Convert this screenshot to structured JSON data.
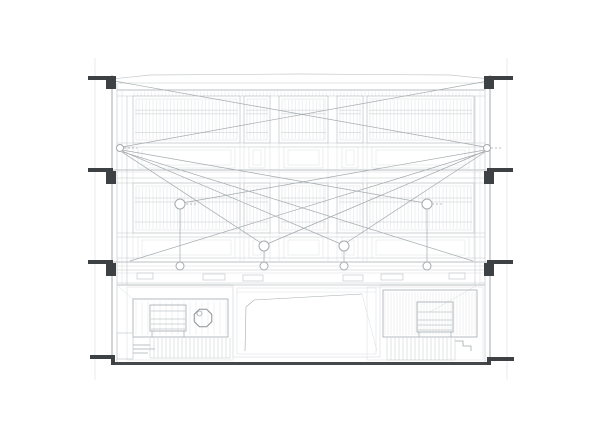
{
  "canvas": {
    "width": 600,
    "height": 423,
    "background": "#ffffff"
  },
  "colors": {
    "faint": "#dadde0",
    "light": "#c4c9cc",
    "mid": "#a4abaf",
    "dark": "#8b9296",
    "ink": "#3e4144",
    "ground": "#45484a",
    "white": "#ffffff"
  },
  "drawing": {
    "guides": {
      "xs": [
        95,
        507
      ],
      "y0": 58,
      "y1": 380
    },
    "roof_arc": [
      [
        112,
        79
      ],
      [
        150,
        75
      ],
      [
        300,
        74
      ],
      [
        450,
        75
      ],
      [
        490,
        79
      ]
    ],
    "slab_lines": {
      "light": [
        [
          118,
          83,
          484
        ],
        [
          117,
          96,
          485
        ],
        [
          117,
          143,
          485
        ],
        [
          117,
          147,
          485
        ],
        [
          117,
          178,
          485
        ],
        [
          117,
          183,
          485
        ],
        [
          117,
          233,
          485
        ],
        [
          117,
          237,
          485
        ],
        [
          117,
          258,
          485
        ],
        [
          117,
          270,
          485
        ],
        [
          117,
          283,
          485
        ]
      ],
      "mid": [
        [
          117,
          90,
          485
        ],
        [
          113,
          170,
          489
        ],
        [
          113,
          262,
          489
        ],
        [
          117,
          285,
          485
        ]
      ],
      "faint": [
        [
          117,
          172,
          485
        ],
        [
          117,
          266,
          485
        ],
        [
          117,
          273,
          485
        ]
      ]
    },
    "walls": {
      "left": [
        {
          "x": 112,
          "y0": 75,
          "y1": 365,
          "tone": "mid",
          "w": 1
        },
        {
          "x": 117,
          "y0": 83,
          "y1": 362,
          "tone": "light",
          "w": 0.7
        },
        {
          "x": 122,
          "y0": 90,
          "y1": 285,
          "tone": "faint",
          "w": 0.5
        },
        {
          "x": 127,
          "y0": 96,
          "y1": 285,
          "tone": "light",
          "w": 0.6
        }
      ],
      "right": [
        {
          "x": 490,
          "y0": 75,
          "y1": 365,
          "tone": "mid",
          "w": 1
        },
        {
          "x": 485,
          "y0": 83,
          "y1": 362,
          "tone": "light",
          "w": 0.7
        },
        {
          "x": 480,
          "y0": 90,
          "y1": 285,
          "tone": "faint",
          "w": 0.5
        },
        {
          "x": 475,
          "y0": 96,
          "y1": 285,
          "tone": "light",
          "w": 0.6
        }
      ]
    },
    "floors": [
      {
        "y0": 96,
        "y1": 143,
        "sp0": 147,
        "sp1": 168
      },
      {
        "y0": 183,
        "y1": 233,
        "sp0": 237,
        "sp1": 258
      }
    ],
    "modules": [
      [
        133,
        240
      ],
      [
        244,
        270
      ],
      [
        279,
        328
      ],
      [
        337,
        363
      ],
      [
        367,
        474
      ]
    ],
    "window_style": {
      "mullion_step": 3.5,
      "h_fracs": [
        0.3,
        0.38,
        0.78
      ]
    },
    "stub_mullions": {
      "x0": 134,
      "x1": 473,
      "step": 3.5,
      "y0": 91.5,
      "y1": 96
    },
    "markers": {
      "left": [
        {
          "bar": [
            88,
            76,
            25,
            4
          ],
          "sq": [
            106,
            76,
            10,
            13
          ]
        },
        {
          "bar": [
            88,
            168,
            25,
            4
          ],
          "sq": [
            106,
            171,
            10,
            13
          ]
        },
        {
          "bar": [
            88,
            260,
            25,
            4
          ],
          "sq": [
            106,
            263,
            10,
            13
          ]
        },
        {
          "bar": [
            90,
            355,
            24,
            4
          ]
        }
      ],
      "right": [
        {
          "bar": [
            487,
            76,
            26,
            4
          ],
          "sq": [
            484,
            76,
            10,
            13
          ]
        },
        {
          "bar": [
            487,
            168,
            26,
            4
          ],
          "sq": [
            484,
            171,
            10,
            13
          ]
        },
        {
          "bar": [
            487,
            260,
            26,
            4
          ],
          "sq": [
            484,
            263,
            10,
            13
          ]
        },
        {
          "bar": [
            489,
            357,
            25,
            4
          ]
        }
      ]
    },
    "vents": [
      [
        137,
        273,
        16,
        6
      ],
      [
        203,
        274,
        22,
        6
      ],
      [
        243,
        275,
        20,
        6
      ],
      [
        343,
        275,
        20,
        6
      ],
      [
        381,
        274,
        22,
        6
      ],
      [
        449,
        273,
        16,
        6
      ]
    ],
    "diagonals": [
      [
        114,
        81,
        485,
        147
      ],
      [
        488,
        81,
        122,
        147
      ],
      [
        122,
        150,
        425,
        203
      ],
      [
        485,
        150,
        182,
        203
      ],
      [
        122,
        151,
        341,
        244
      ],
      [
        485,
        151,
        267,
        244
      ],
      [
        122,
        152,
        261,
        243
      ],
      [
        485,
        152,
        346,
        243
      ],
      [
        123,
        152,
        473,
        261
      ],
      [
        484,
        152,
        130,
        261
      ]
    ],
    "dashed_ticks": [
      [
        124,
        148,
        137,
        148
      ],
      [
        491,
        148,
        503,
        148
      ],
      [
        186,
        204,
        197,
        204
      ],
      [
        432,
        204,
        443,
        204
      ]
    ],
    "nodes": {
      "wall": [
        [
          120,
          148,
          3.5
        ],
        [
          487,
          148,
          3.5
        ]
      ],
      "upper": [
        [
          180,
          204,
          5
        ],
        [
          427,
          204,
          5
        ]
      ],
      "mid": [
        [
          264,
          246,
          5
        ],
        [
          344,
          246,
          5
        ]
      ],
      "bottom": [
        [
          180,
          266,
          4
        ],
        [
          264,
          266,
          4
        ],
        [
          344,
          266,
          4
        ],
        [
          427,
          266,
          4
        ]
      ]
    },
    "connectors": [
      [
        180,
        209,
        180,
        262
      ],
      [
        427,
        209,
        427,
        262
      ],
      [
        264,
        251,
        264,
        262
      ],
      [
        344,
        251,
        344,
        262
      ]
    ],
    "ground": {
      "main": [
        113,
        362,
        377,
        3
      ],
      "left_step": [
        111,
        355,
        4,
        10
      ],
      "right_step": [
        487,
        357,
        4,
        8
      ]
    },
    "ground_floor": {
      "left_room": [
        127,
        287,
        106,
        73
      ],
      "right_room": [
        367,
        287,
        116,
        73
      ],
      "center_outer": [
        233,
        285,
        147,
        72
      ],
      "center_inner": [
        237,
        288,
        139,
        66
      ],
      "center_line_y": 292,
      "center_poly": [
        [
          245,
          351
        ],
        [
          246,
          307
        ],
        [
          254,
          300
        ],
        [
          362,
          294
        ]
      ],
      "center_diag": [
        [
          362,
          294
        ],
        [
          377,
          351
        ]
      ],
      "left_table": [
        133,
        299,
        95,
        38
      ],
      "left_hatch": {
        "x0": 136,
        "x1": 226,
        "step": 6,
        "y0": 301,
        "y1": 335
      },
      "left_bench": [
        150,
        305,
        36,
        26
      ],
      "left_slats": [
        311,
        319,
        324,
        329
      ],
      "left_slat_x": [
        151,
        185
      ],
      "left_legs": [
        [
          152,
          331,
          152,
          337
        ],
        [
          184,
          331,
          184,
          337
        ]
      ],
      "octagon": {
        "cx": 203,
        "cy": 318,
        "r": 9.5
      },
      "octagon_inner": {
        "cx": 199.5,
        "cy": 313.5,
        "r": 2.5
      },
      "left_stairs": {
        "x0": 150,
        "x1": 230,
        "step": 4,
        "y0": 338,
        "y1": 358
      },
      "left_wall_box": [
        117,
        333,
        16,
        26
      ],
      "left_steps": [
        [
          133,
          345,
          150,
          345
        ],
        [
          133,
          349,
          155,
          349
        ],
        [
          133,
          353,
          148,
          353
        ]
      ],
      "left_diag": [
        [
          119,
          287
        ],
        [
          133,
          299
        ]
      ],
      "right_table": [
        383,
        290,
        94,
        47
      ],
      "right_hatch": {
        "x0": 385,
        "x1": 475,
        "step": 3,
        "y0": 292,
        "y1": 335
      },
      "right_bench": [
        417,
        302,
        36,
        30
      ],
      "right_slats": [
        312,
        320,
        325,
        330
      ],
      "right_slat_x": [
        418,
        452
      ],
      "right_legs": [
        [
          419,
          332,
          419,
          337
        ],
        [
          451,
          332,
          451,
          337
        ]
      ],
      "right_stairs": {
        "x0": 387,
        "x1": 455,
        "step": 4,
        "y0": 338,
        "y1": 360
      },
      "right_steps": [
        [
          455,
          341
        ],
        [
          463,
          341
        ],
        [
          463,
          346
        ],
        [
          471,
          346
        ],
        [
          471,
          351
        ]
      ],
      "right_diag": [
        [
          483,
          282
        ],
        [
          430,
          312
        ]
      ]
    }
  }
}
